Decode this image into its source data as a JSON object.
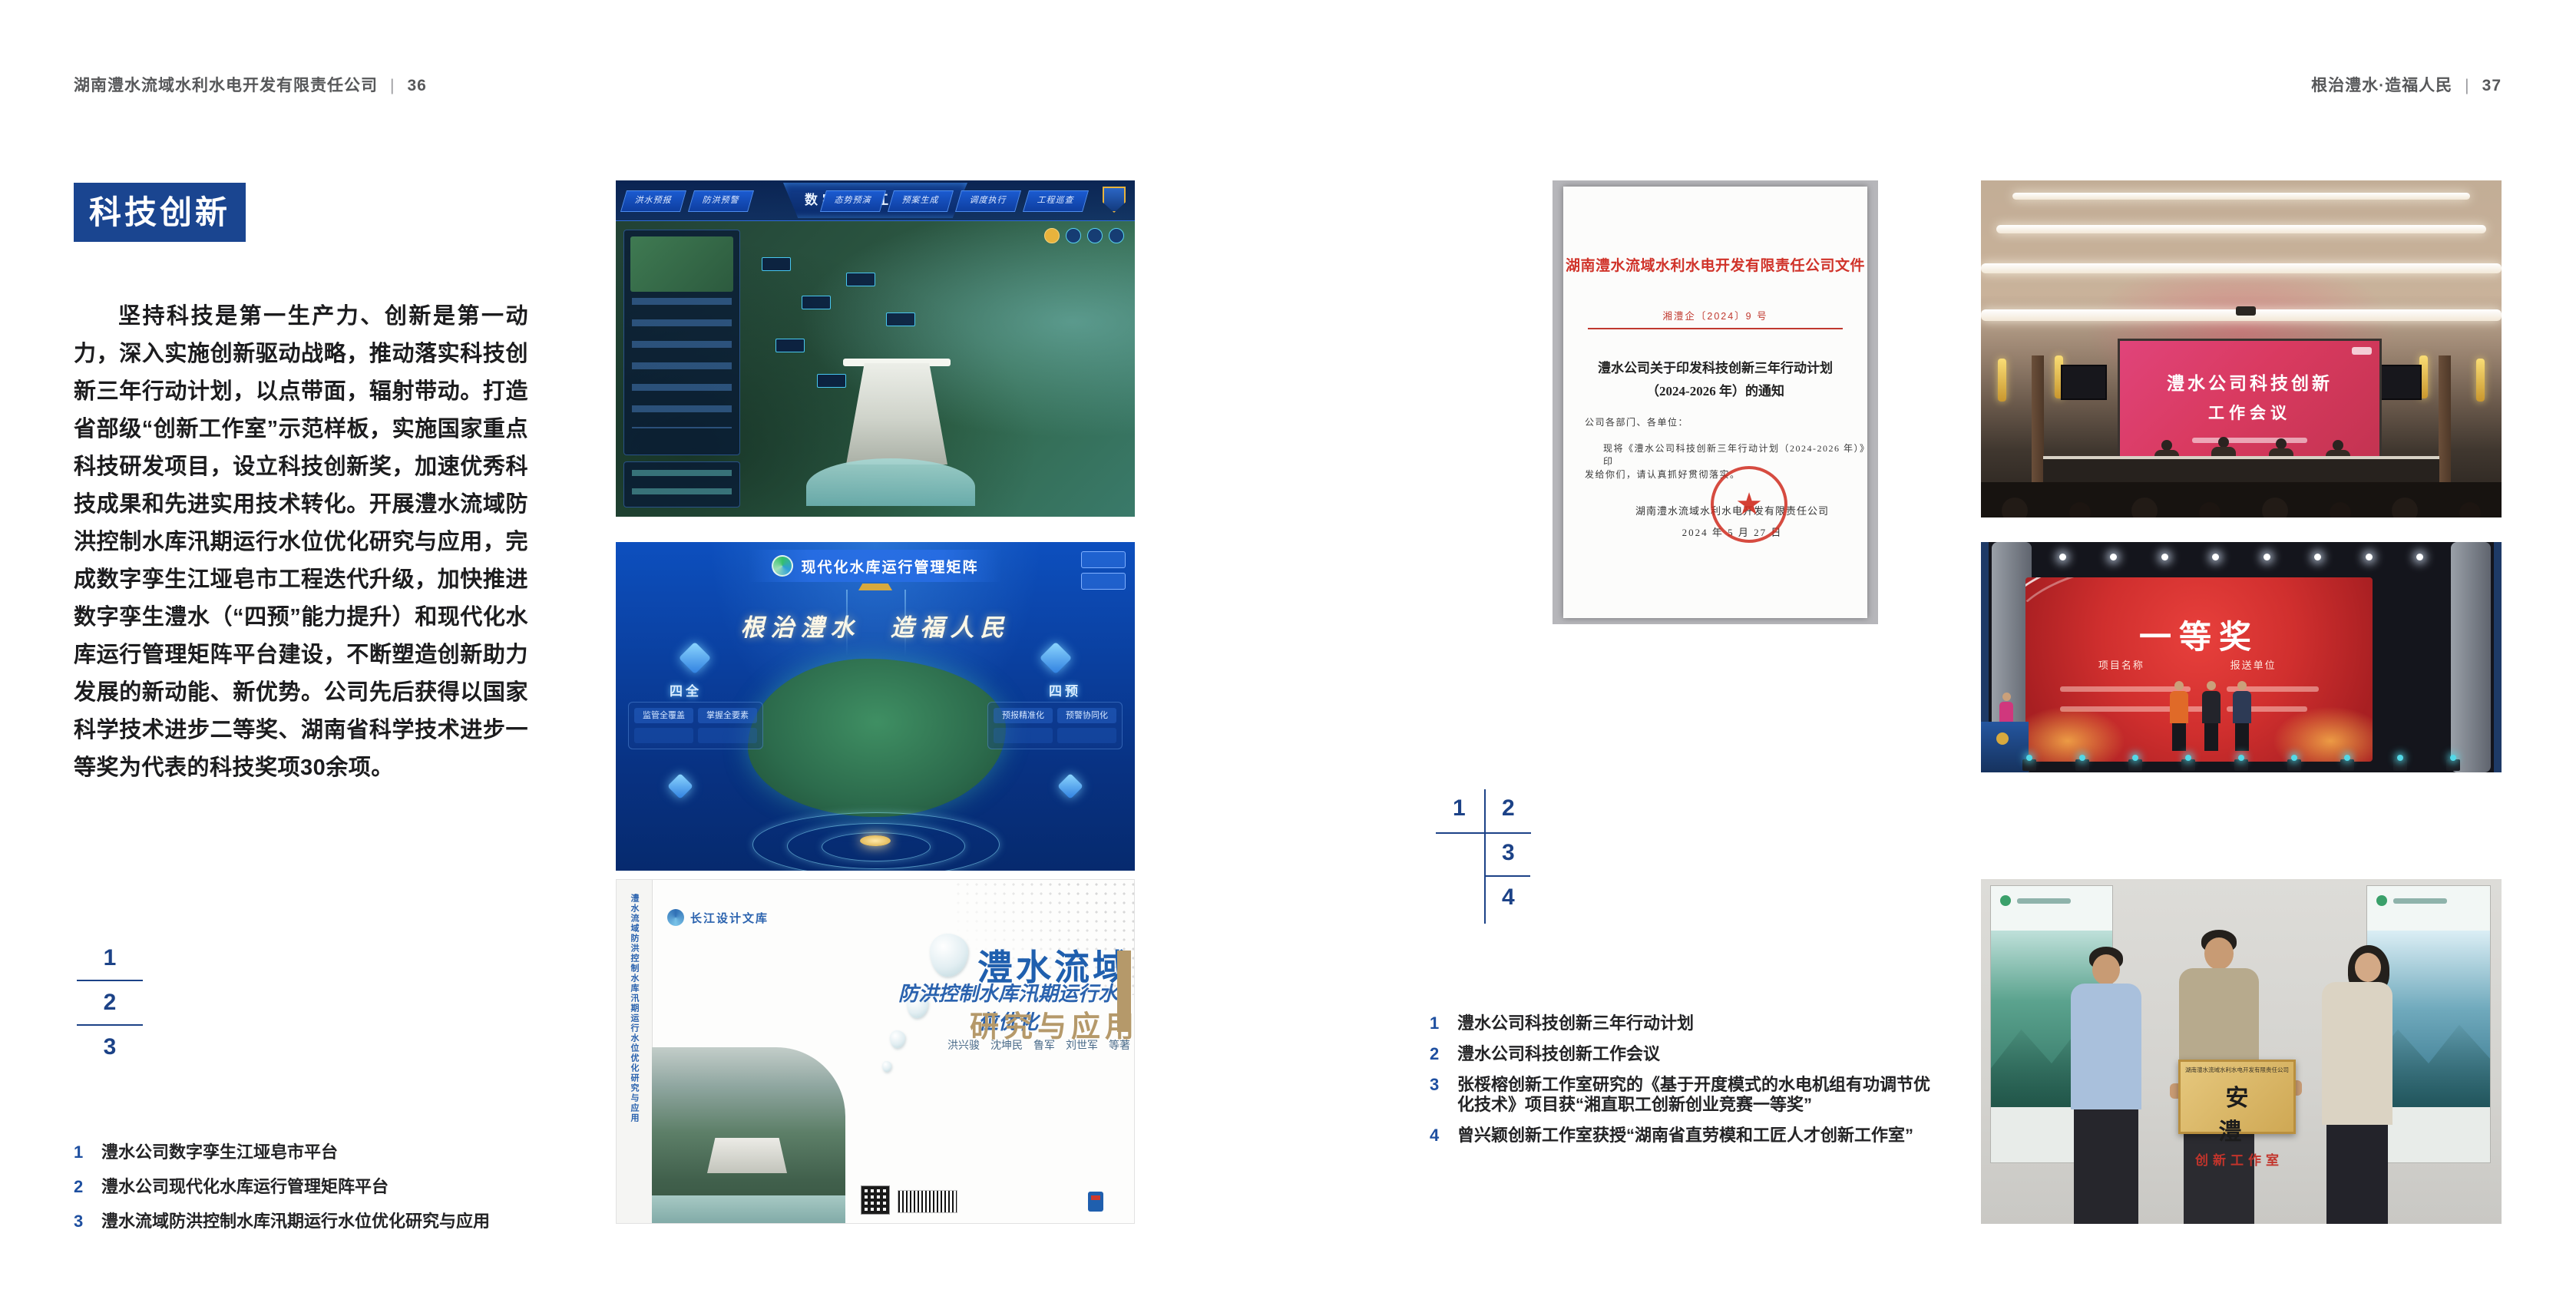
{
  "colors": {
    "accent_blue": "#1a4590",
    "key_number_blue": "#1c4287",
    "caption_number_blue": "#1e4fa0",
    "document_red": "#d0332a",
    "award_screen_red": "#d02f2e",
    "plaque_gold": "#d9b96c",
    "book_title_blue": "#1f5fae",
    "book_subtitle_tan": "#b5996a"
  },
  "header_left": {
    "title": "湖南澧水流域水利水电开发有限责任公司",
    "separator": "|",
    "page_number": "36"
  },
  "header_right": {
    "title": "根治澧水·造福人民",
    "separator": "|",
    "page_number": "37"
  },
  "page_left": {
    "section_title": "科技创新",
    "body_paragraph": "坚持科技是第一生产力、创新是第一动力，深入实施创新驱动战略，推动落实科技创新三年行动计划，以点带面，辐射带动。打造省部级“创新工作室”示范样板，实施国家重点科技研发项目，设立科技创新奖，加速优秀科技成果和先进实用技术转化。开展澧水流域防洪控制水库汛期运行水位优化研究与应用，完成数字孪生江垭皂市工程迭代升级，加快推进数字孪生澧水（“四预”能力提升）和现代化水库运行管理矩阵平台建设，不断塑造创新助力发展的新动能、新优势。公司先后获得以国家科学技术进步二等奖、湖南省科学技术进步一等奖为代表的科技奖项30余项。",
    "figure_key": [
      "1",
      "2",
      "3"
    ],
    "captions": [
      {
        "num": "1",
        "text": "澧水公司数字孪生江垭皂市平台"
      },
      {
        "num": "2",
        "text": "澧水公司现代化水库运行管理矩阵平台"
      },
      {
        "num": "3",
        "text": "澧水流域防洪控制水库汛期运行水位优化研究与应用"
      }
    ],
    "dashboard": {
      "title": "数字孪生江垭皂市",
      "tabs_left": [
        "洪水预报",
        "防洪预警"
      ],
      "tabs_right": [
        "态势预演",
        "预案生成",
        "调度执行",
        "工程巡查"
      ]
    },
    "matrix": {
      "title": "现代化水库运行管理矩阵",
      "slogan": "根治澧水　造福人民",
      "node_left_label": "四全",
      "node_left_pills": [
        "监管全覆盖",
        "掌握全要素"
      ],
      "node_right_label": "四预",
      "node_right_pills": [
        "预报精准化",
        "预警协同化"
      ]
    },
    "book": {
      "series": "长江设计文库",
      "title_line1": "澧水流域",
      "title_line2": "防洪控制水库汛期运行水位优化",
      "title_line3": "研究与应用",
      "authors": "洪兴骏　沈坤民　鲁军　刘世军　等著",
      "spine_text": "澧水流域防洪控制水库汛期运行水位优化研究与应用"
    }
  },
  "page_right": {
    "document": {
      "header": "湖南澧水流域水利水电开发有限责任公司文件",
      "doc_number": "湘澧企〔2024〕9 号",
      "title_line1": "澧水公司关于印发科技创新三年行动计划",
      "title_line2": "（2024-2026 年）的通知",
      "salutation": "公司各部门、各单位：",
      "body_line1": "现将《澧水公司科技创新三年行动计划（2024-2026 年）》印",
      "body_line2": "发给你们，请认真抓好贯彻落实。",
      "seal_star_icon": "★",
      "signature": "湖南澧水流域水利水电开发有限责任公司",
      "date": "2024 年 5 月 27 日"
    },
    "figure_key": [
      "1",
      "2",
      "3",
      "4"
    ],
    "captions": [
      {
        "num": "1",
        "text": "澧水公司科技创新三年行动计划"
      },
      {
        "num": "2",
        "text": "澧水公司科技创新工作会议"
      },
      {
        "num": "3",
        "text": "张桵榕创新工作室研究的《基于开度模式的水电机组有功调节优化技术》项目获“湘直职工创新创业竞赛一等奖”"
      },
      {
        "num": "4",
        "text": "曾兴颖创新工作室获授“湖南省直劳模和工匠人才创新工作室”"
      }
    ],
    "meeting": {
      "screen_line1": "澧水公司科技创新",
      "screen_line2": "工作会议"
    },
    "award": {
      "title": "一等奖",
      "label_left": "项目名称",
      "label_right": "报送单位"
    },
    "plaque": {
      "header": "湖南澧水流域水利水电开发有限责任公司",
      "title": "安　澧",
      "subtitle": "创新工作室"
    }
  }
}
